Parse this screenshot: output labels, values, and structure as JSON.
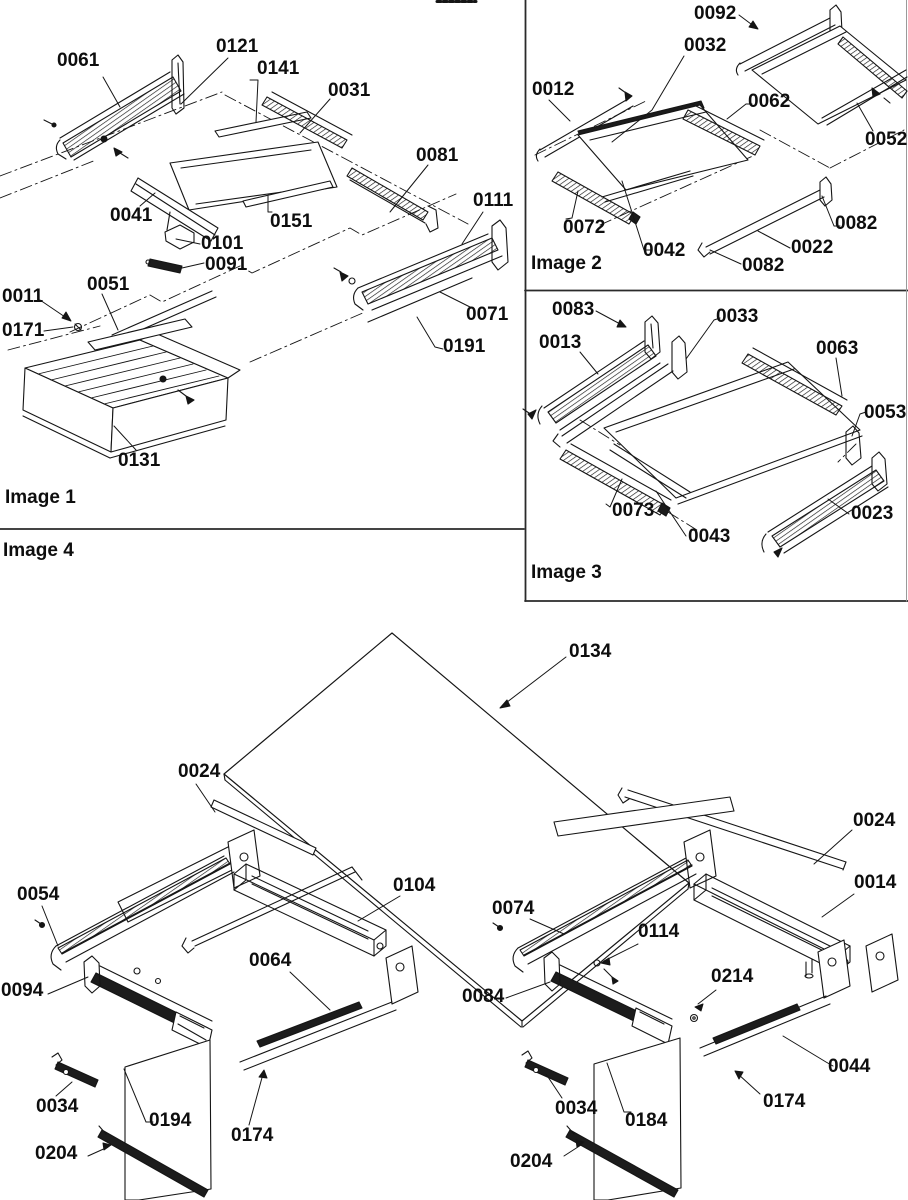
{
  "document": {
    "type": "exploded-parts-diagram",
    "background": "#ffffff",
    "ink_color": "#111111"
  },
  "captions": [
    {
      "id": "image-1",
      "text": "Image 1",
      "x": 5,
      "y": 488
    },
    {
      "id": "image-2",
      "text": "Image 2",
      "x": 531,
      "y": 254
    },
    {
      "id": "image-3",
      "text": "Image 3",
      "x": 531,
      "y": 563
    },
    {
      "id": "image-4",
      "text": "Image 4",
      "x": 3,
      "y": 541
    }
  ],
  "part_labels": [
    {
      "text": "0061",
      "x": 57,
      "y": 51,
      "panel": "image-1"
    },
    {
      "text": "0121",
      "x": 216,
      "y": 37,
      "panel": "image-1"
    },
    {
      "text": "0141",
      "x": 257,
      "y": 59,
      "panel": "image-1"
    },
    {
      "text": "0031",
      "x": 328,
      "y": 81,
      "panel": "image-1"
    },
    {
      "text": "0081",
      "x": 416,
      "y": 146,
      "panel": "image-1"
    },
    {
      "text": "0041",
      "x": 110,
      "y": 206,
      "panel": "image-1"
    },
    {
      "text": "0151",
      "x": 270,
      "y": 212,
      "panel": "image-1"
    },
    {
      "text": "0101",
      "x": 201,
      "y": 234,
      "panel": "image-1"
    },
    {
      "text": "0091",
      "x": 205,
      "y": 255,
      "panel": "image-1"
    },
    {
      "text": "0111",
      "x": 473,
      "y": 191,
      "panel": "image-1"
    },
    {
      "text": "0051",
      "x": 87,
      "y": 275,
      "panel": "image-1"
    },
    {
      "text": "0011",
      "x": 2,
      "y": 287,
      "panel": "image-1"
    },
    {
      "text": "0171",
      "x": 2,
      "y": 321,
      "panel": "image-1"
    },
    {
      "text": "0071",
      "x": 466,
      "y": 305,
      "panel": "image-1"
    },
    {
      "text": "0191",
      "x": 443,
      "y": 337,
      "panel": "image-1"
    },
    {
      "text": "0131",
      "x": 118,
      "y": 451,
      "panel": "image-1"
    },
    {
      "text": "0092",
      "x": 694,
      "y": 4,
      "panel": "image-2"
    },
    {
      "text": "0032",
      "x": 684,
      "y": 36,
      "panel": "image-2"
    },
    {
      "text": "0012",
      "x": 532,
      "y": 80,
      "panel": "image-2"
    },
    {
      "text": "0062",
      "x": 748,
      "y": 92,
      "panel": "image-2"
    },
    {
      "text": "0052",
      "x": 865,
      "y": 130,
      "panel": "image-2"
    },
    {
      "text": "0072",
      "x": 563,
      "y": 218,
      "panel": "image-2"
    },
    {
      "text": "0042",
      "x": 643,
      "y": 241,
      "panel": "image-2"
    },
    {
      "text": "0082",
      "x": 835,
      "y": 214,
      "panel": "image-2"
    },
    {
      "text": "0022",
      "x": 791,
      "y": 238,
      "panel": "image-2"
    },
    {
      "text": "0082",
      "x": 742,
      "y": 256,
      "panel": "image-2"
    },
    {
      "text": "0083",
      "x": 552,
      "y": 300,
      "panel": "image-3"
    },
    {
      "text": "0033",
      "x": 716,
      "y": 307,
      "panel": "image-3"
    },
    {
      "text": "0013",
      "x": 539,
      "y": 333,
      "panel": "image-3"
    },
    {
      "text": "0063",
      "x": 816,
      "y": 339,
      "panel": "image-3"
    },
    {
      "text": "0053",
      "x": 864,
      "y": 403,
      "panel": "image-3"
    },
    {
      "text": "0073",
      "x": 612,
      "y": 501,
      "panel": "image-3"
    },
    {
      "text": "0043",
      "x": 688,
      "y": 527,
      "panel": "image-3"
    },
    {
      "text": "0023",
      "x": 851,
      "y": 504,
      "panel": "image-3"
    },
    {
      "text": "0134",
      "x": 569,
      "y": 642,
      "panel": "image-4"
    },
    {
      "text": "0024",
      "x": 178,
      "y": 762,
      "panel": "image-4"
    },
    {
      "text": "0024",
      "x": 853,
      "y": 811,
      "panel": "image-4"
    },
    {
      "text": "0054",
      "x": 17,
      "y": 885,
      "panel": "image-4"
    },
    {
      "text": "0104",
      "x": 393,
      "y": 876,
      "panel": "image-4"
    },
    {
      "text": "0074",
      "x": 492,
      "y": 899,
      "panel": "image-4"
    },
    {
      "text": "0014",
      "x": 854,
      "y": 873,
      "panel": "image-4"
    },
    {
      "text": "0064",
      "x": 249,
      "y": 951,
      "panel": "image-4"
    },
    {
      "text": "0114",
      "x": 638,
      "y": 922,
      "panel": "image-4"
    },
    {
      "text": "0094",
      "x": 1,
      "y": 981,
      "panel": "image-4"
    },
    {
      "text": "0084",
      "x": 462,
      "y": 987,
      "panel": "image-4"
    },
    {
      "text": "0214",
      "x": 711,
      "y": 967,
      "panel": "image-4"
    },
    {
      "text": "0034",
      "x": 36,
      "y": 1097,
      "panel": "image-4"
    },
    {
      "text": "0194",
      "x": 149,
      "y": 1111,
      "panel": "image-4"
    },
    {
      "text": "0174",
      "x": 231,
      "y": 1126,
      "panel": "image-4"
    },
    {
      "text": "0204",
      "x": 35,
      "y": 1144,
      "panel": "image-4"
    },
    {
      "text": "0034",
      "x": 555,
      "y": 1099,
      "panel": "image-4"
    },
    {
      "text": "0184",
      "x": 625,
      "y": 1111,
      "panel": "image-4"
    },
    {
      "text": "0174",
      "x": 763,
      "y": 1092,
      "panel": "image-4"
    },
    {
      "text": "0044",
      "x": 828,
      "y": 1057,
      "panel": "image-4"
    },
    {
      "text": "0204",
      "x": 510,
      "y": 1152,
      "panel": "image-4"
    }
  ]
}
